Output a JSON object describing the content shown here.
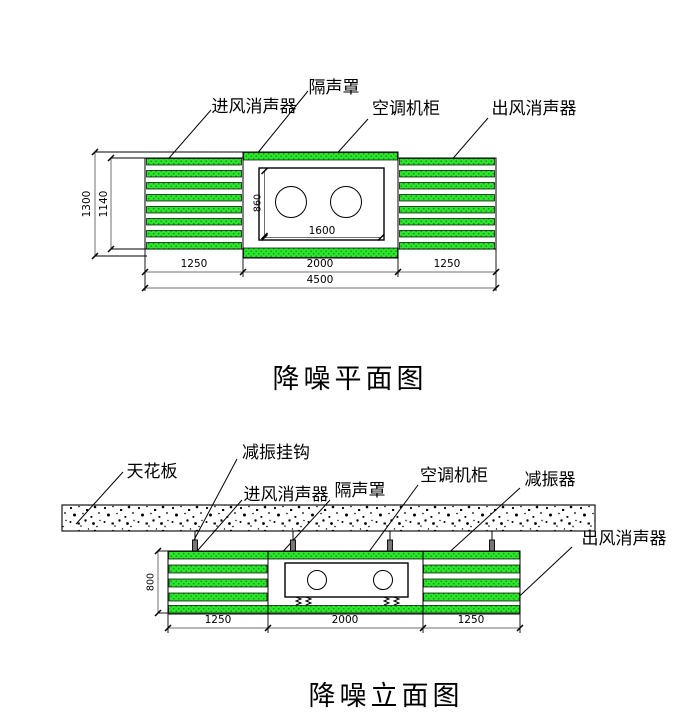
{
  "plan": {
    "title": "降噪平面图",
    "labels": {
      "inlet_silencer": "进风消声器",
      "enclosure": "隔声罩",
      "cabinet": "空调机柜",
      "outlet_silencer": "出风消声器"
    },
    "dims": {
      "enclosure_depth": "1300",
      "silencer_depth": "1140",
      "cabinet_depth": "860",
      "cabinet_width": "1600",
      "left_silencer_len": "1250",
      "enclosure_len": "2000",
      "right_silencer_len": "1250",
      "total_len": "4500"
    }
  },
  "elevation": {
    "title": "降噪立面图",
    "labels": {
      "ceiling": "天花板",
      "hanger": "减振挂钩",
      "inlet_silencer": "进风消声器",
      "enclosure": "隔声罩",
      "cabinet": "空调机柜",
      "damper": "减振器",
      "outlet_silencer": "出风消声器"
    },
    "dims": {
      "body_height": "800",
      "left_silencer_len": "1250",
      "enclosure_len": "2000",
      "right_silencer_len": "1250"
    }
  },
  "colors": {
    "baffle_green": "#2de52d",
    "baffle_green_dot": "#0a9e0a",
    "outline": "#000000",
    "dim_gray": "#707070"
  }
}
